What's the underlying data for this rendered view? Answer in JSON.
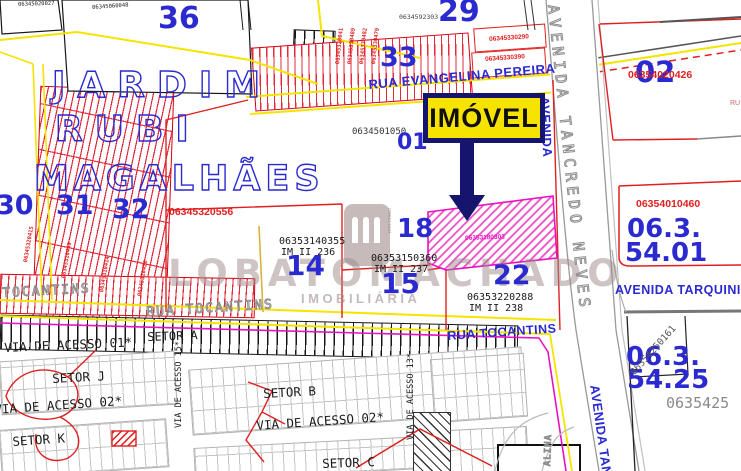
{
  "callout": {
    "label": "IMÓVEL"
  },
  "title_lines": {
    "l1": "JARDIM",
    "l2": "RUBI",
    "l3": "MAGALHÃES"
  },
  "parcels": {
    "p36": "36",
    "p29": "29",
    "p33": "33",
    "p30": "30",
    "p31": "31",
    "p32": "32",
    "p01": "01",
    "p02": "02",
    "p18": "18",
    "p14": "14",
    "p15": "15",
    "p22": "22"
  },
  "zones": {
    "z5401a": "06.3.",
    "z5401b": "54.01",
    "z5425a": "06.3.",
    "z5425b": "54.25"
  },
  "streets": {
    "evangelina": "RUA EVANGELINA PEREIRA",
    "tancredo_outline": "AVENIDA TANCREDO NEVES",
    "tancredo_blue_top": "AVENIDA",
    "tancredo_blue_bottom": "AVENIDA TANC",
    "tarquinio": "AVENIDA TARQUINIO",
    "tocantins_left": "TOCANTINS",
    "tocantins_mid": "RUA TOCANTINS",
    "tocantins_blue": "RUA TOCANTINS",
    "via01": "VIA DE ACESSO 01*",
    "via02_left": "VIA DE ACESSO 02*",
    "via02_mid": "VIA DE ACESSO 02*",
    "via15": "VIA DE ACESSO 15*",
    "via13": "VIA DE ACESSO 13*",
    "partial_vert": "ALINA",
    "partial_ru": "RU"
  },
  "sectors": {
    "a": "SETOR A",
    "b": "SETOR B",
    "c": "SETOR C",
    "j": "SETOR J",
    "k": "SETOR K"
  },
  "codes": {
    "tl1": "06345020027",
    "tl2": "06345060048",
    "under29": "0634592303",
    "col33": [
      "06345320041",
      "06345330489",
      "06345330482",
      "06345330479"
    ],
    "right33a": "06345330290",
    "right33b": "06345330390",
    "p01": "0634501050",
    "jardim": "06345320556",
    "lots": [
      "06345320415",
      "06345310449",
      "06345310414",
      "06345310426"
    ],
    "p02": "06354020426",
    "z5401": "06354010460",
    "pink": "06353180303",
    "diag5425": "06354250161",
    "partial5425": "0635425",
    "im14": {
      "code": "06353140355",
      "im": "IM II 236"
    },
    "im15": {
      "code": "06353150360",
      "im": "IM II 237"
    },
    "im22": {
      "code": "06353220288",
      "im": "IM II 238"
    }
  },
  "watermark": {
    "name": "LOBATOMACHADO",
    "subtitle": "IMOBILIÁRIA",
    "creci": "CRECI-1044"
  },
  "colors": {
    "blue": "#2a2ad0",
    "red": "#e02020",
    "magenta": "#e911c0",
    "yellow": "#f6e400",
    "navy": "#15156e",
    "gray_outline": "#8d8d8d",
    "watermark": "#9b8888"
  }
}
